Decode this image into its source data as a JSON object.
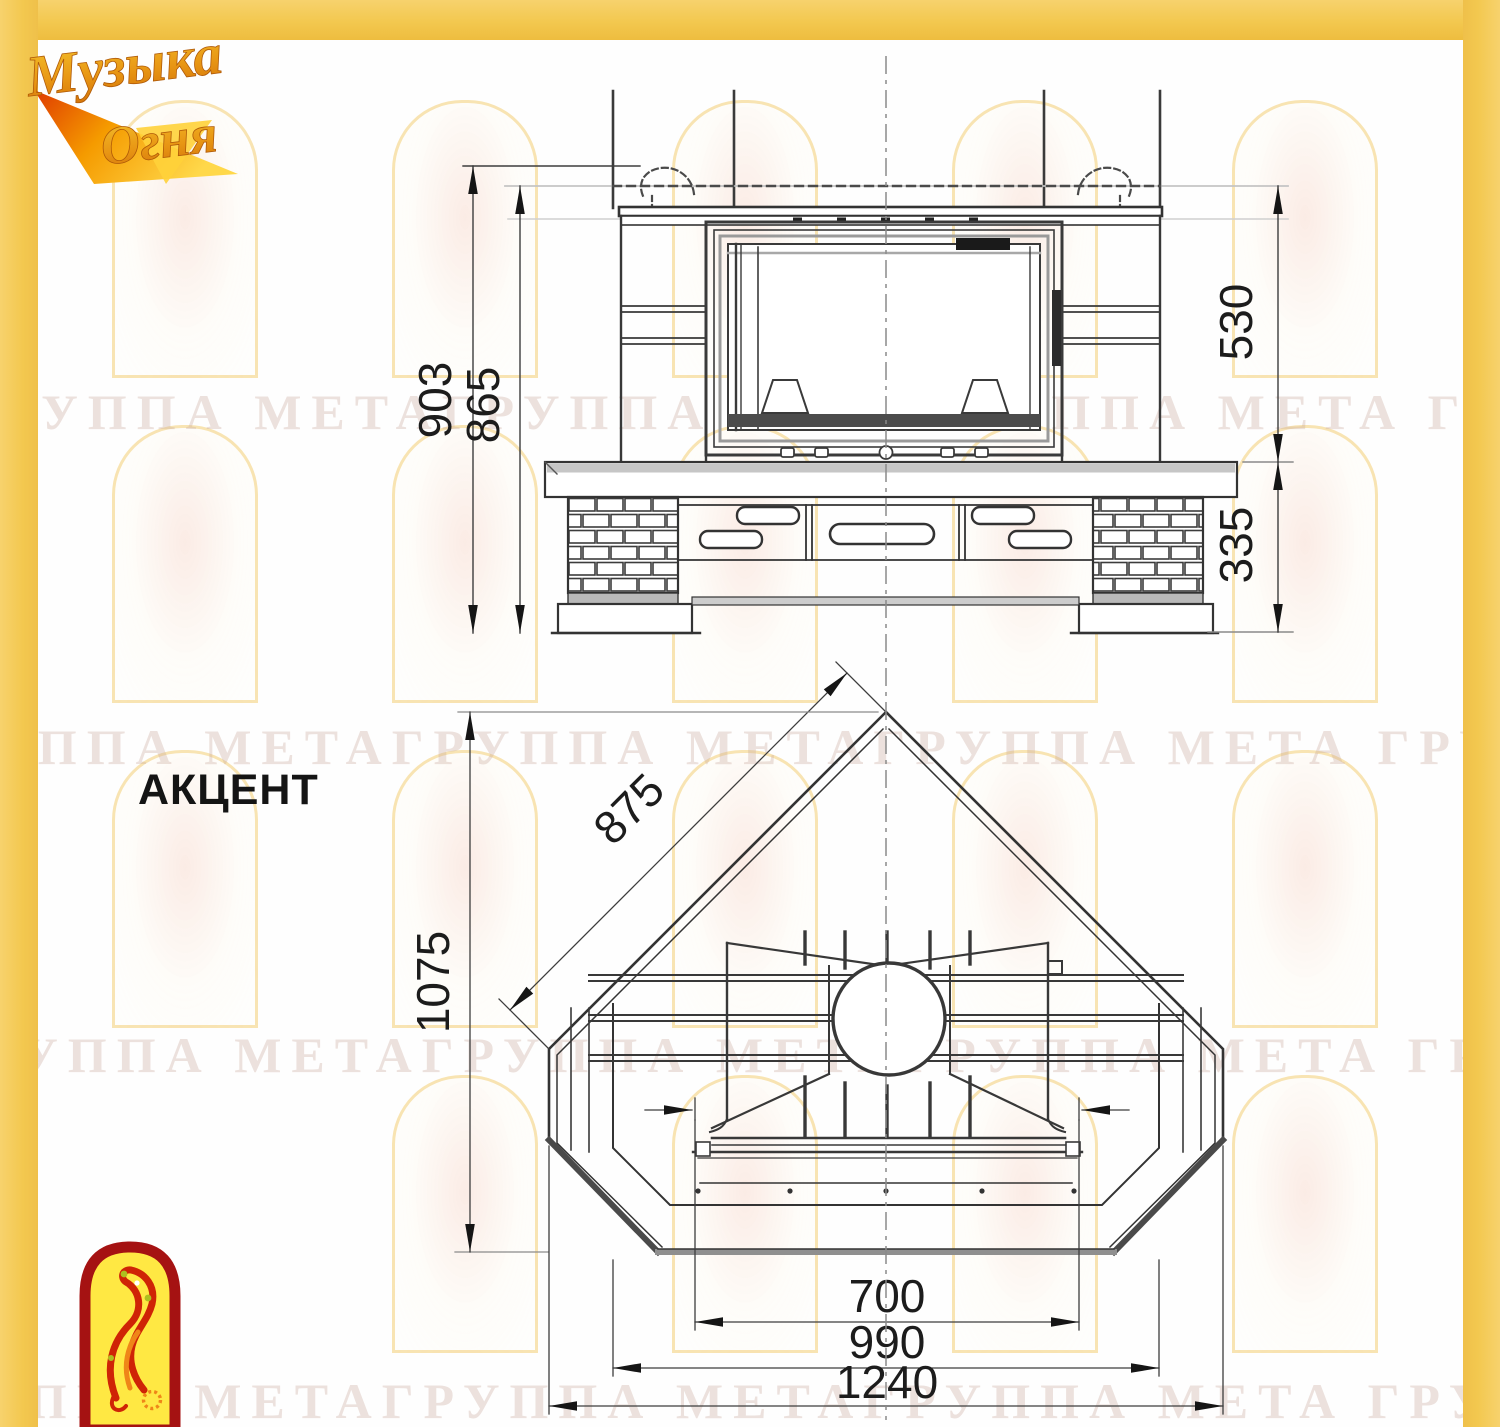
{
  "brand": {
    "line1": "Музыка",
    "line2": "Огня"
  },
  "model": {
    "title": "АКЦЕНТ"
  },
  "watermark": {
    "row_text": "ГРУППА МЕТАГРУППА МЕТАГРУППА МЕТА ГРУППА МЕТАГРУППА МЕТА"
  },
  "front_view": {
    "dims": {
      "height_total": "903",
      "height_to_fold": "865",
      "upper_section": "530",
      "base_section": "335"
    }
  },
  "plan_view": {
    "dims": {
      "back_wall": "875",
      "depth": "1075",
      "firebox_width": "700",
      "mid_width": "990",
      "total_width": "1240"
    }
  },
  "colors": {
    "frame_yellow": "#f3c84f",
    "line_dark": "#383838",
    "logo_red": "#a51212",
    "logo_yellow": "#ffe843",
    "logo_orange": "#ef8618"
  }
}
